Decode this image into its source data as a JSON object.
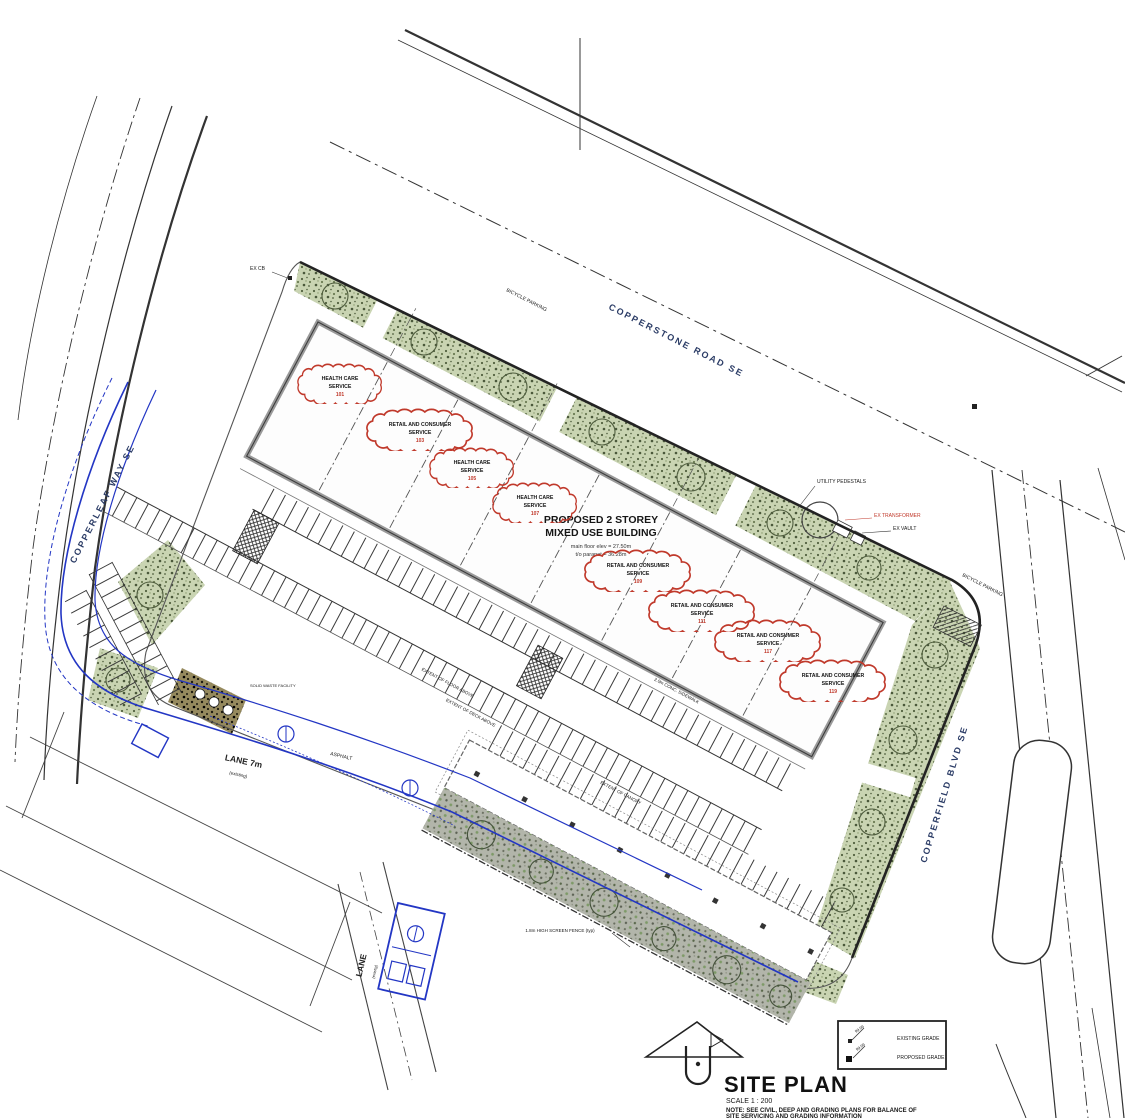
{
  "streets": {
    "copperstone": "COPPERSTONE ROAD SE",
    "copperleaf": "COPPERLEAF WAY SE",
    "copperfield": "COPPERFIELD BLVD SE",
    "lane_west": "LANE 7m",
    "lane_west_sub": "(existing)",
    "lane_south": "LANE",
    "lane_south_sub": "(exist'g)"
  },
  "building": {
    "title_line1": "PROPOSED 2 STOREY",
    "title_line2": "MIXED USE BUILDING",
    "elev_line1": "main floor elev = 27.50m",
    "elev_line2": "t/o parapet = 36.28m"
  },
  "clouds": [
    {
      "line1": "HEALTH CARE",
      "line2": "SERVICE",
      "num": "101"
    },
    {
      "line1": "RETAIL AND CONSUMER",
      "line2": "SERVICE",
      "num": "103"
    },
    {
      "line1": "HEALTH CARE",
      "line2": "SERVICE",
      "num": "105"
    },
    {
      "line1": "HEALTH CARE",
      "line2": "SERVICE",
      "num": "107"
    },
    {
      "line1": "RETAIL AND CONSUMER",
      "line2": "SERVICE",
      "num": "109"
    },
    {
      "line1": "RETAIL AND CONSUMER",
      "line2": "SERVICE",
      "num": "111"
    },
    {
      "line1": "RETAIL AND CONSUMER",
      "line2": "SERVICE",
      "num": "117"
    },
    {
      "line1": "RETAIL AND CONSUMER",
      "line2": "SERVICE",
      "num": "119"
    }
  ],
  "callouts": {
    "ex_cb": "EX CB",
    "bicycle_parking_top": "BICYCLE PARKING",
    "bicycle_parking_right": "BICYCLE PARKING",
    "utility_pedestals": "UTILITY PEDESTALS",
    "ex_transformer": "EX TRANSFORMER",
    "ex_vault": "EX VAULT",
    "asphalt": "ASPHALT",
    "conc_sidewalk": "2.0m CONC. SIDEWALK",
    "extent_floor": "EXTENT OF FLOOR ABOVE",
    "extent_deck": "EXTENT OF DECK ABOVE",
    "extent_canopy": "EXTENT OF CANOPY",
    "screen_fence": "1.8m HIGH SCREEN FENCE (typ)",
    "waste": "SOLID WASTE FACILITY"
  },
  "titleblock": {
    "title": "SITE PLAN",
    "scale": "SCALE 1 : 200",
    "note1": "NOTE: SEE CIVIL, DEEP AND GRADING PLANS FOR BALANCE OF",
    "note2": "SITE SERVICING AND GRADING INFORMATION"
  },
  "legend": {
    "existing_label": "EXISTING GRADE",
    "proposed_label": "PROPOSED GRADE",
    "existing_val": "99.99",
    "proposed_val": "99.99"
  },
  "colors": {
    "landscape_green": "#c9d4b2",
    "cloud_red": "#c0392b",
    "proposed_blue": "#2336c4",
    "line_dark": "#333333"
  }
}
